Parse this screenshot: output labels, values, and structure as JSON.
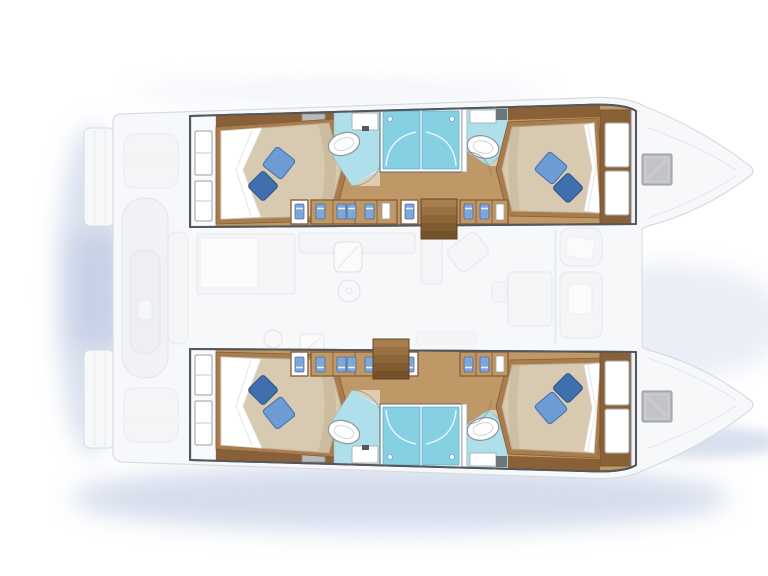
{
  "page": {
    "title": "Catamaran interior layout plan",
    "description": "Top-view floor plan of a sailing catamaran, bow pointing right. Four double cabins with blue pillows and four bathrooms with shower stalls are highlighted in warm wood tones inside the two hulls; the saloon, galley, cockpits, swim platforms and bows are shown as faded white outlines over a soft blue water shadow."
  },
  "colors": {
    "wood-floor": "#c09767",
    "wood-dark": "#8a6136",
    "wood-mid": "#aa7c4c",
    "wood-step": "#9a7143",
    "mattress": "#d8cab0",
    "mattress-shade": "#c2b294",
    "sheet": "#ffffff",
    "pillow-light": "#6d9bd3",
    "pillow-dark": "#3f6fae",
    "shower": "#85d0e3",
    "bath-floor": "#aedfeb",
    "fixture": "#ffffff",
    "vent-gray": "#b9babc",
    "hatch-gray": "#b6b8bb",
    "deck-faded": "#f7f8fa",
    "deck-stroke": "#d7dbe1",
    "furniture-faded": "#f3f4f6",
    "shadow-blue": "#b3c1de",
    "glyph-blue": "#7fa8d9",
    "hull-border": "#54575c"
  },
  "vessel": {
    "type": "catamaran",
    "orientation": "bow-right",
    "hulls": [
      {
        "id": "port-hull",
        "position": "top",
        "rooms": [
          {
            "name": "aft-cabin",
            "features": [
              "double-berth",
              "two-blue-pillows",
              "white-sheet",
              "hull-windows"
            ]
          },
          {
            "name": "aft-bathroom",
            "features": [
              "oval-washbasin",
              "vanity-counter"
            ]
          },
          {
            "name": "aft-shower-stall",
            "features": [
              "glass-door"
            ]
          },
          {
            "name": "forward-shower-stall",
            "features": [
              "glass-door"
            ]
          },
          {
            "name": "forward-bathroom",
            "features": [
              "oval-washbasin",
              "vanity-cabinet"
            ]
          },
          {
            "name": "forward-cabin",
            "features": [
              "double-berth",
              "two-blue-pillows",
              "white-sheet",
              "headboard-panels"
            ]
          },
          {
            "name": "companionway-stairs"
          },
          {
            "name": "corridor-lockers"
          }
        ]
      },
      {
        "id": "starboard-hull",
        "position": "bottom",
        "rooms": [
          {
            "name": "aft-cabin",
            "features": [
              "double-berth",
              "two-blue-pillows",
              "white-sheet",
              "hull-windows"
            ]
          },
          {
            "name": "aft-bathroom",
            "features": [
              "oval-washbasin",
              "vanity-counter"
            ]
          },
          {
            "name": "aft-shower-stall",
            "features": [
              "glass-door"
            ]
          },
          {
            "name": "forward-shower-stall",
            "features": [
              "glass-door"
            ]
          },
          {
            "name": "forward-bathroom",
            "features": [
              "oval-washbasin",
              "vanity-cabinet"
            ]
          },
          {
            "name": "forward-cabin",
            "features": [
              "double-berth",
              "two-blue-pillows",
              "white-sheet",
              "headboard-panels"
            ]
          },
          {
            "name": "companionway-stairs"
          },
          {
            "name": "corridor-lockers"
          }
        ]
      }
    ],
    "center_deck": [
      "aft-swim-platforms",
      "tender-davit-bay",
      "aft-cockpit",
      "galley",
      "saloon-dinette",
      "forward-cockpit-seats",
      "trampoline-area",
      "bow-hatches"
    ]
  }
}
